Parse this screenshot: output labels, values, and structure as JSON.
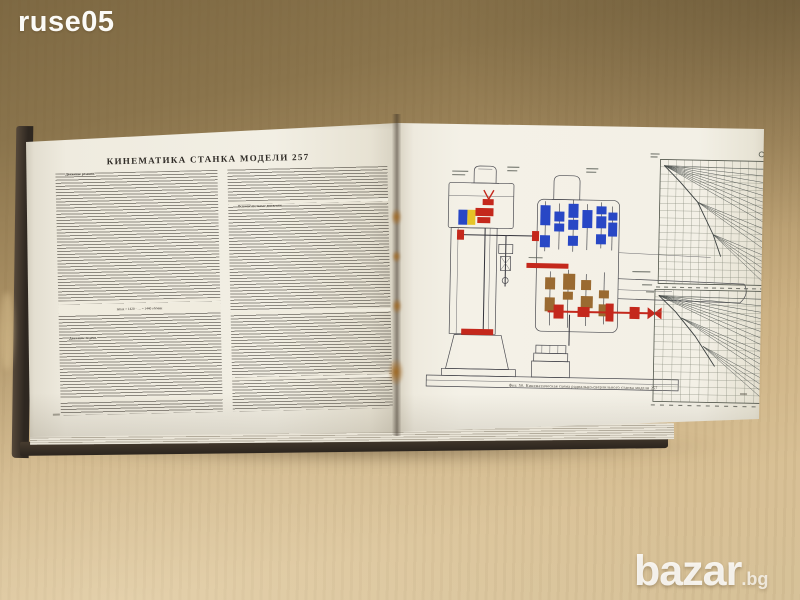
{
  "scene": {
    "photo_watermark": "ruse05",
    "marketplace_name": "bazar",
    "marketplace_tld": ".bg"
  },
  "book": {
    "left_page": {
      "title": "КИНЕМАТИКА СТАНКА МОДЕЛИ 257",
      "lead_1": "Движение резания.",
      "lead_2": "Движение подачи.",
      "lead_3": "Вспомогательные движения.",
      "formula": "nmax = 1420 · … = 1440 об/мин"
    },
    "right_page": {
      "figure_caption": "Фиг. 50. Кинематическая схема радиально-сверлильного станка модели 257"
    }
  },
  "colors": {
    "wood-top": "#85704a",
    "wood-bottom": "#d8c094",
    "cover": "#352c23",
    "page": "#f2eee3",
    "ink": "#2f2b26",
    "gear-red": "#c4281c",
    "gear-blue": "#2847c5",
    "gear-yellow": "#e6c428",
    "gear-brown": "#9a6a31",
    "line-dark": "#4a4a50",
    "chart-line": "#474c4a",
    "stain": "#a06820"
  },
  "chart_data": [
    {
      "type": "line",
      "name": "spindle-speed-ray-chart",
      "description": "Ray (fan) diagram of spindle speeds on grid; numeric labels illegible in photo",
      "rays": 18,
      "grid": true,
      "layout": {
        "x": 248,
        "y": 18,
        "w": 104,
        "h": 124,
        "cols": 13,
        "rows": 17,
        "ray_y0": 26,
        "ray_y1": 138,
        "label_w": 6,
        "origins": [
          [
            252,
            24
          ],
          [
            252,
            24
          ],
          [
            286,
            60
          ],
          [
            302,
            92
          ]
        ],
        "trunk": [
          "252,24 268,40 286,60 302,92 310,114"
        ]
      }
    },
    {
      "type": "line",
      "name": "feed-ray-chart",
      "description": "Ray (fan) diagram of feeds on grid; numeric labels illegible in photo",
      "rays": 16,
      "grid": true,
      "layout": {
        "x": 245,
        "y": 148,
        "w": 110,
        "h": 112,
        "cols": 12,
        "rows": 15,
        "ray_y0": 156,
        "ray_y1": 256,
        "label_w": 7,
        "origins": [
          [
            249,
            154
          ],
          [
            249,
            154
          ],
          [
            272,
            176
          ],
          [
            294,
            204
          ]
        ],
        "trunk": [
          "249,154 266,170 286,194 306,224"
        ]
      }
    }
  ]
}
